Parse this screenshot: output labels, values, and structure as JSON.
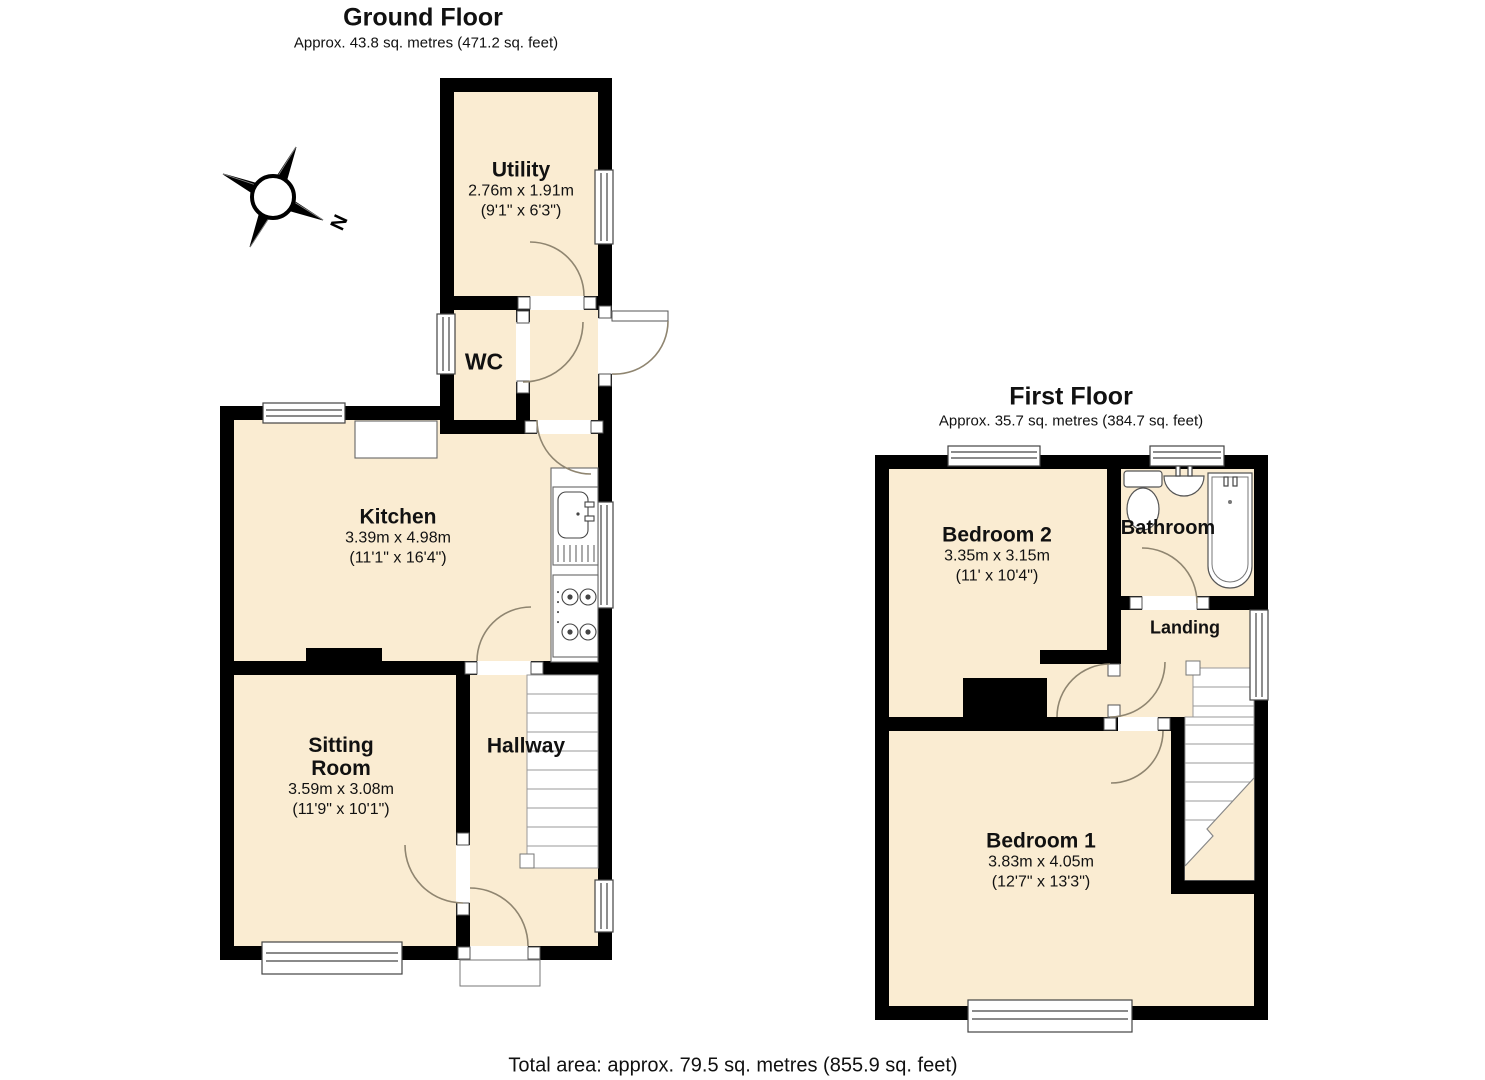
{
  "page": {
    "total_area_label": "Total area: approx. 79.5 sq. metres (855.9 sq. feet)"
  },
  "colors": {
    "room_fill": "#faecd2",
    "wall": "#000000",
    "door_arc": "#8f8570",
    "fixture_stroke": "#555555"
  },
  "ground_floor": {
    "title": "Ground Floor",
    "subtitle": "Approx. 43.8 sq. metres (471.2 sq. feet)",
    "compass_label": "N",
    "rooms": {
      "utility": {
        "name": "Utility",
        "size_metric": "2.76m x 1.91m",
        "size_imperial": "(9'1\" x 6'3\")"
      },
      "wc": {
        "name": "WC"
      },
      "kitchen": {
        "name": "Kitchen",
        "size_metric": "3.39m x 4.98m",
        "size_imperial": "(11'1\" x 16'4\")"
      },
      "sitting_room": {
        "name": "Sitting Room",
        "size_metric": "3.59m x 3.08m",
        "size_imperial": "(11'9\" x 10'1\")"
      },
      "hallway": {
        "name": "Hallway"
      }
    }
  },
  "first_floor": {
    "title": "First Floor",
    "subtitle": "Approx. 35.7 sq. metres (384.7 sq. feet)",
    "rooms": {
      "bedroom_2": {
        "name": "Bedroom 2",
        "size_metric": "3.35m x 3.15m",
        "size_imperial": "(11' x 10'4\")"
      },
      "bathroom": {
        "name": "Bathroom"
      },
      "landing": {
        "name": "Landing"
      },
      "bedroom_1": {
        "name": "Bedroom 1",
        "size_metric": "3.83m x 4.05m",
        "size_imperial": "(12'7\" x 13'3\")"
      }
    }
  }
}
